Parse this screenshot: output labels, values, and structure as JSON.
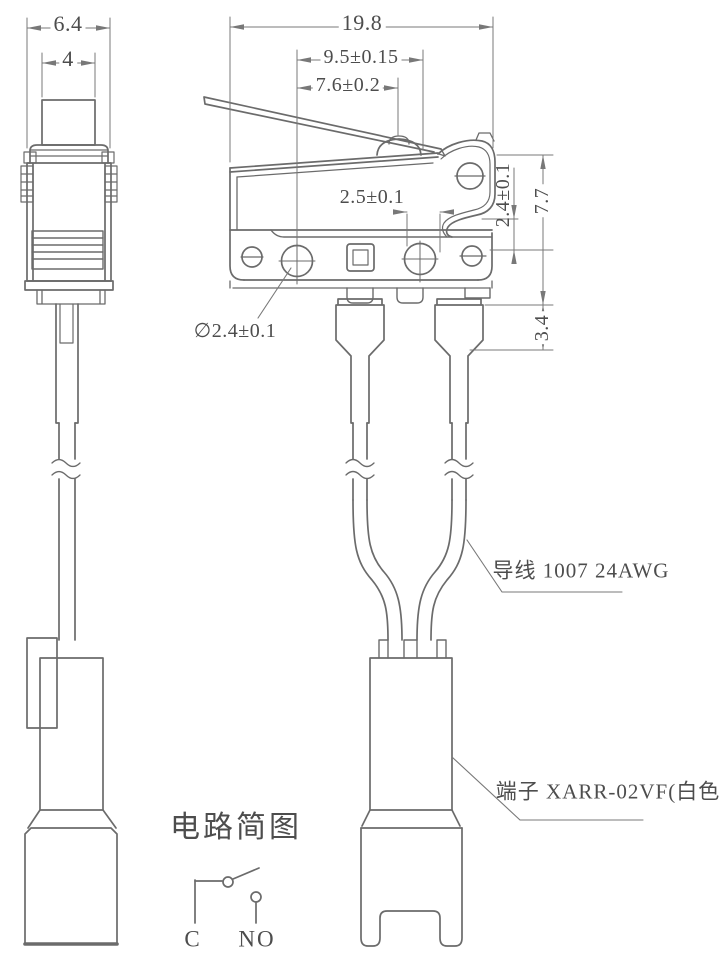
{
  "drawing_title": "micro switch with lever, wires and fork terminal - outline drawing",
  "colors": {
    "background": "#ffffff",
    "part_line": "#6b6b6b",
    "dimension_line": "#787878",
    "text": "#4d4d4d"
  },
  "dimensions": {
    "side_width": "6.4",
    "button_width": "4",
    "total_width": "19.8",
    "hole_pitch": "9.5±0.15",
    "lever_pitch": "7.6±0.2",
    "slot_width": "2.5±0.1",
    "hole_diameter": "∅2.4±0.1",
    "right_offset": "2.4±0.1",
    "body_height": "7.7",
    "sleeve_height": "3.4"
  },
  "labels": {
    "wire": "导线 1007 24AWG",
    "terminal": "端子 XARR-02VF(白色)"
  },
  "circuit": {
    "title": "电路简图",
    "terminal_common": "C",
    "terminal_normally_open": "NO"
  }
}
